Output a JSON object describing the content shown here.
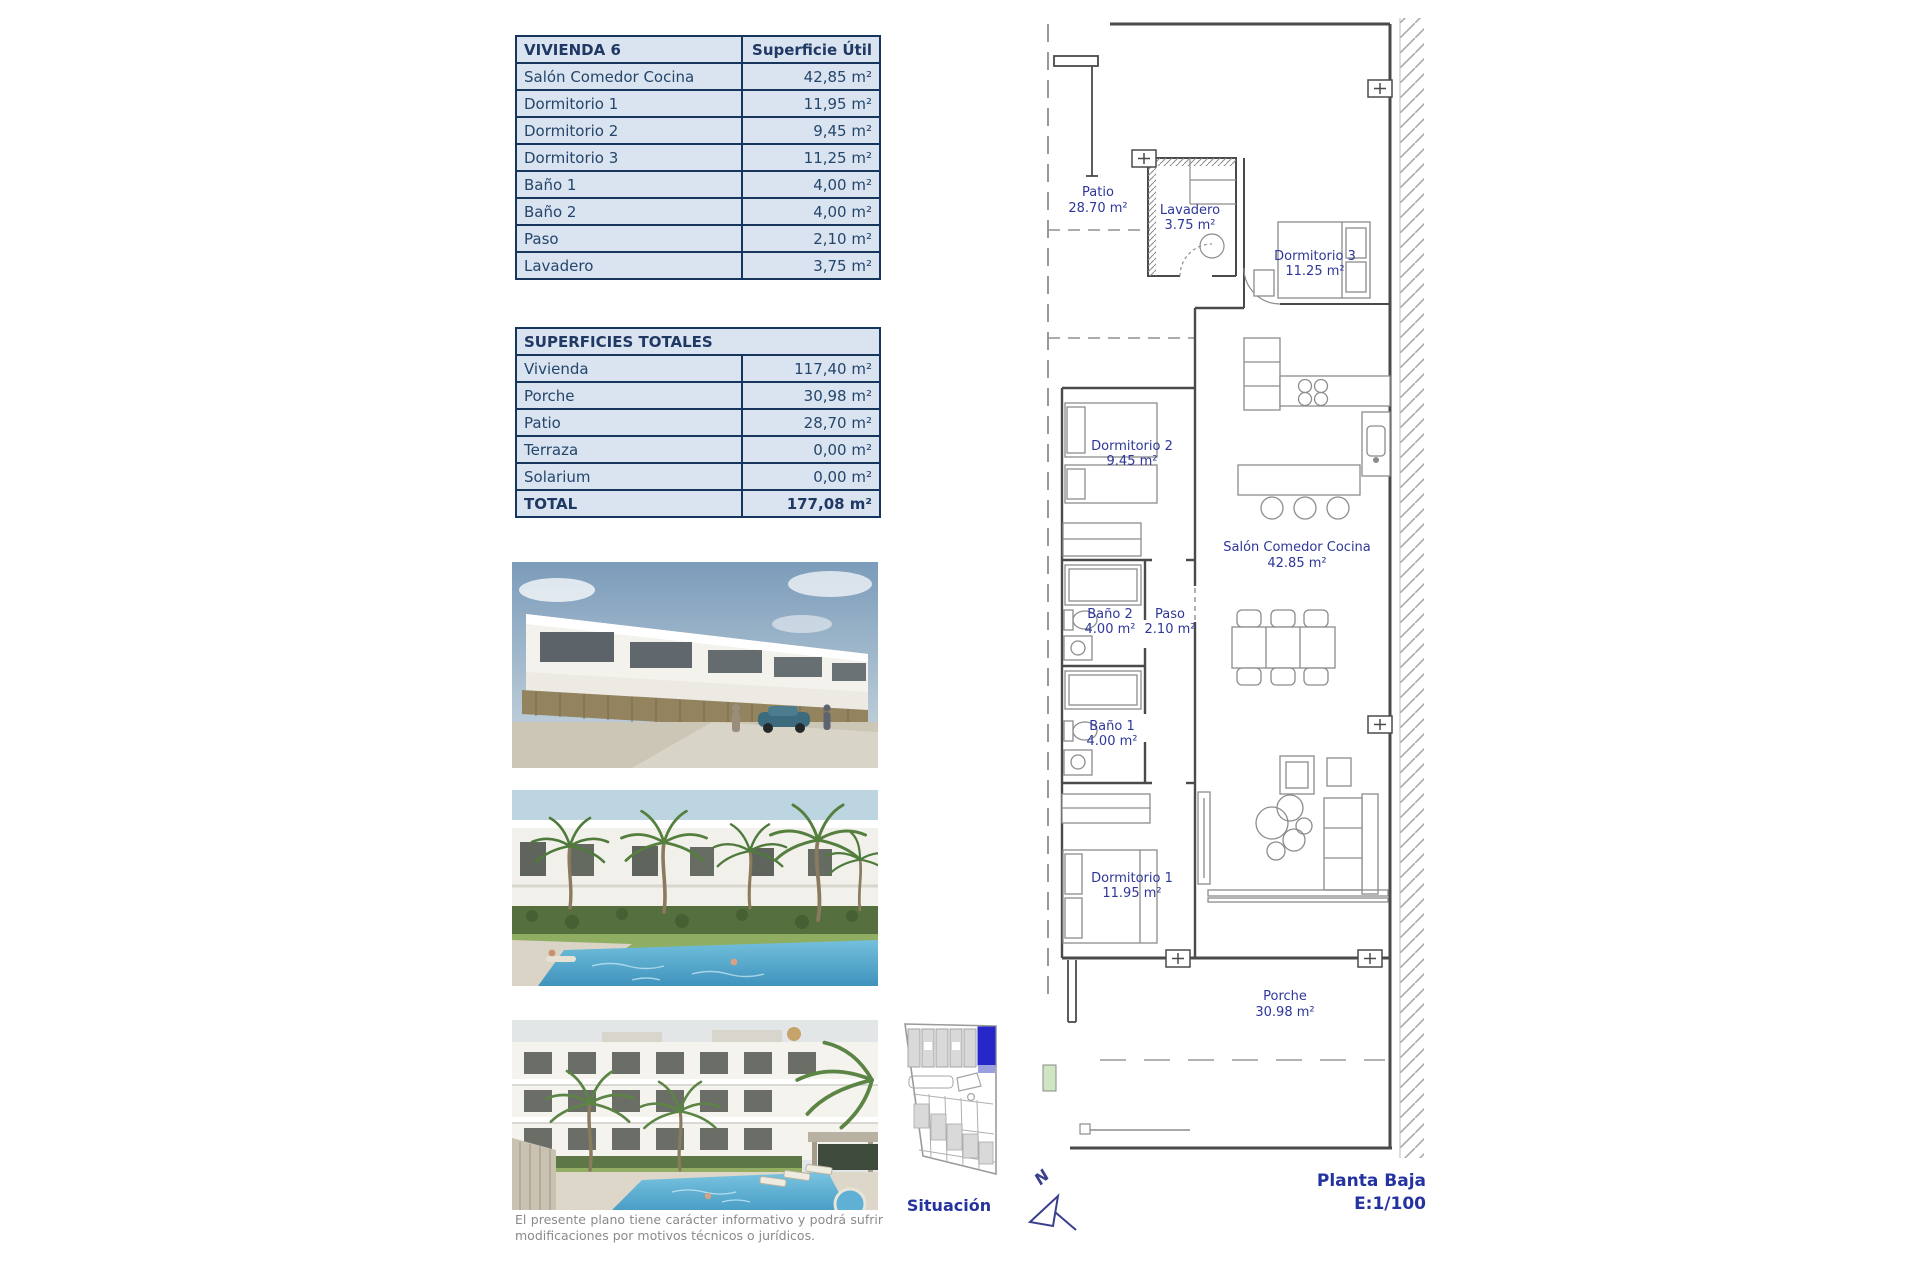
{
  "unit_table": {
    "title": "VIVIENDA 6",
    "header_value": "Superficie Útil",
    "rows": [
      {
        "label": "Salón Comedor Cocina",
        "value": "42,85 m²"
      },
      {
        "label": "Dormitorio 1",
        "value": "11,95 m²"
      },
      {
        "label": "Dormitorio 2",
        "value": "9,45 m²"
      },
      {
        "label": "Dormitorio 3",
        "value": "11,25 m²"
      },
      {
        "label": "Baño 1",
        "value": "4,00 m²"
      },
      {
        "label": "Baño 2",
        "value": "4,00 m²"
      },
      {
        "label": "Paso",
        "value": "2,10 m²"
      },
      {
        "label": "Lavadero",
        "value": "3,75 m²"
      }
    ]
  },
  "totals_table": {
    "title": "SUPERFICIES TOTALES",
    "rows": [
      {
        "label": "Vivienda",
        "value": "117,40 m²"
      },
      {
        "label": "Porche",
        "value": "30,98 m²"
      },
      {
        "label": "Patio",
        "value": "28,70 m²"
      },
      {
        "label": "Terraza",
        "value": "0,00 m²"
      },
      {
        "label": "Solarium",
        "value": "0,00 m²"
      }
    ],
    "total_row": {
      "label": "TOTAL",
      "value": "177,08 m²"
    }
  },
  "floor_plan": {
    "rooms": [
      {
        "name": "Patio",
        "area": "28.70 m²"
      },
      {
        "name": "Lavadero",
        "area": "3.75 m²"
      },
      {
        "name": "Dormitorio 3",
        "area": "11.25 m²"
      },
      {
        "name": "Dormitorio 2",
        "area": "9.45 m²"
      },
      {
        "name": "Salón Comedor Cocina",
        "area": "42.85 m²"
      },
      {
        "name": "Baño 2",
        "area": "4.00 m²"
      },
      {
        "name": "Paso",
        "area": "2.10 m²"
      },
      {
        "name": "Baño 1",
        "area": "4.00 m²"
      },
      {
        "name": "Dormitorio 1",
        "area": "11.95 m²"
      },
      {
        "name": "Porche",
        "area": "30.98 m²"
      }
    ],
    "plan_title": "Planta Baja",
    "scale": "E:1/100",
    "north_label": "N"
  },
  "site_map": {
    "caption": "Situación"
  },
  "disclaimer": "El presente plano tiene carácter informativo y podrá sufrir modificaciones por motivos técnicos o jurídicos.",
  "colors": {
    "table_fill": "#dae3f0",
    "table_border": "#17365d",
    "table_text": "#24466b",
    "plan_label": "#2e3799",
    "highlight_blue": "#2626c9"
  }
}
